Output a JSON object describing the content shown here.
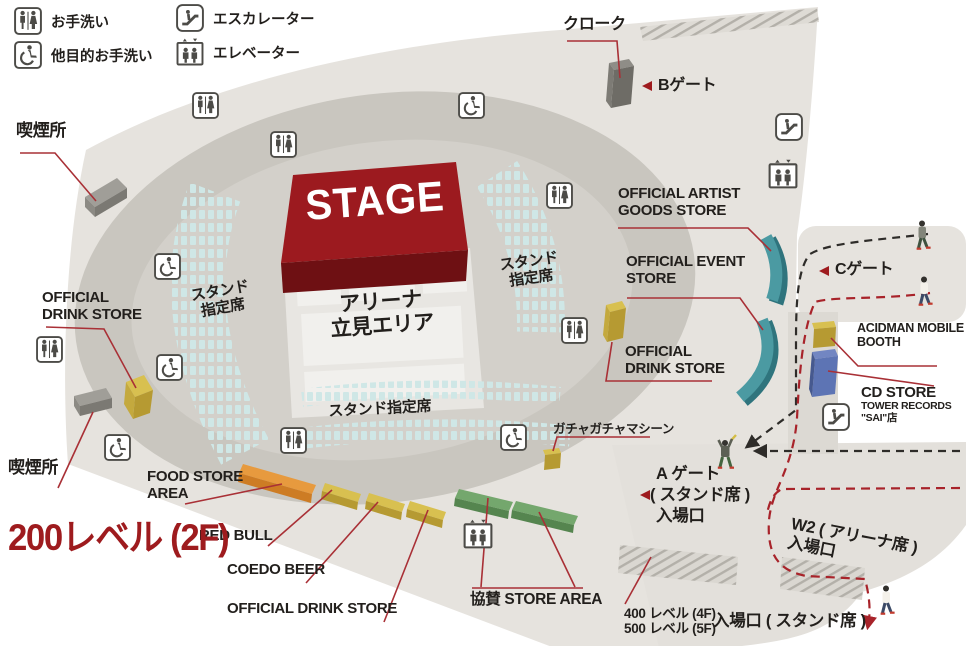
{
  "legend": {
    "items": [
      {
        "icon": "restroom-icon",
        "label": "お手洗い"
      },
      {
        "icon": "accessible-restroom-icon",
        "label": "他目的お手洗い"
      },
      {
        "icon": "escalator-icon",
        "label": "エスカレーター"
      },
      {
        "icon": "elevator-icon",
        "label": "エレベーター"
      }
    ]
  },
  "title_area": {
    "level_line1": "200レベル",
    "level_line2": "(2F)"
  },
  "map": {
    "stage_label": "STAGE",
    "arena_line1": "アリーナ",
    "arena_line2": "立見エリア",
    "stand_left_line1": "スタンド",
    "stand_left_line2": "指定席",
    "stand_right_line1": "スタンド",
    "stand_right_line2": "指定席",
    "stand_bottom": "スタンド指定席",
    "cloak": "クローク",
    "smoking_upper": "喫煙所",
    "smoking_lower": "喫煙所",
    "gacha": "ガチャガチャマシーン",
    "gate_b": "Bゲート",
    "gate_c": "Cゲート",
    "gate_a_line1": "A ゲート",
    "gate_a_line2": "( スタンド席 )",
    "gate_a_line3": "入場口",
    "w2_line1": "W2 ( アリーナ席 )",
    "w2_line2": "入場口",
    "level400": "400 レベル (4F)",
    "level500": "500 レベル (5F)",
    "stand_entrance": "入場口 ( スタンド席 )"
  },
  "stores": {
    "artist_goods_line1": "OFFICIAL ARTIST",
    "artist_goods_line2": "GOODS STORE",
    "event_line1": "OFFICIAL EVENT",
    "event_line2": "STORE",
    "drink_right_line1": "OFFICIAL",
    "drink_right_line2": "DRINK STORE",
    "drink_left_line1": "OFFICIAL",
    "drink_left_line2": "DRINK STORE",
    "drink_bottom": "OFFICIAL DRINK STORE",
    "acidman_line1": "ACIDMAN MOBILE",
    "acidman_line2": "BOOTH",
    "cd_line1": "CD STORE",
    "cd_line2": "TOWER RECORDS",
    "cd_line3": "\"SAI\"店",
    "food_line1": "FOOD STORE",
    "food_line2": "AREA",
    "redbull": "RED BULL",
    "coedo": "COEDO BEER",
    "sponsor": "協賛 STORE AREA"
  },
  "colors": {
    "accent_red": "#9e1b1e",
    "leader_red": "#a93036",
    "route_red": "#a8232a",
    "route_black": "#2e2c29",
    "seat": "#cfe7e6",
    "stage_red": "#9c1a1f",
    "store_yellow": "#d8c050",
    "store_orange": "#e79a3e",
    "store_green": "#74a76d",
    "store_teal": "#4b9aa2",
    "store_blue": "#5d74b4",
    "facility_gray": "#9b9993"
  }
}
